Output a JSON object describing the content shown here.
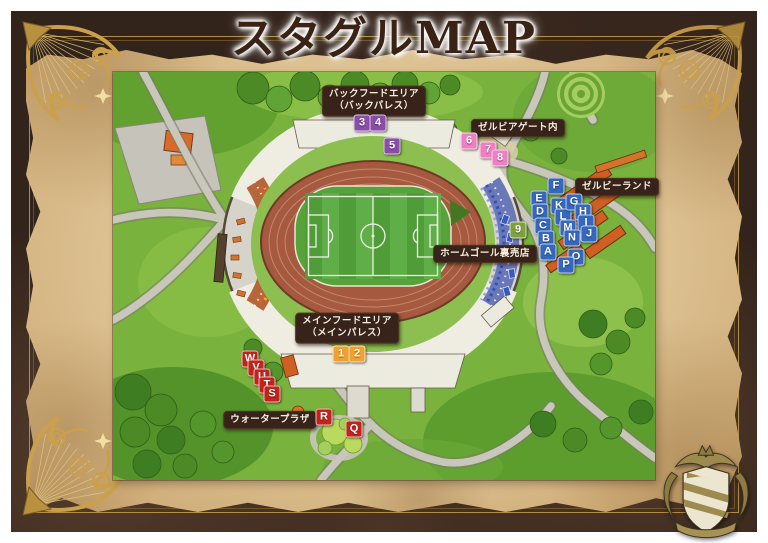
{
  "title": "スタグルMAP",
  "area_labels": [
    {
      "id": "back-food-area",
      "lines": [
        "バックフードエリア",
        "（バックパレス）"
      ],
      "cx": 374,
      "cy": 101
    },
    {
      "id": "zelvia-gate",
      "lines": [
        "ゼルビアゲート内"
      ],
      "cx": 518,
      "cy": 128
    },
    {
      "id": "zelvie-land",
      "lines": [
        "ゼルビーランド"
      ],
      "cx": 617,
      "cy": 187
    },
    {
      "id": "home-goal-shops",
      "lines": [
        "ホームゴール裏売店"
      ],
      "cx": 485,
      "cy": 254
    },
    {
      "id": "main-food-area",
      "lines": [
        "メインフードエリア",
        "（メインパレス）"
      ],
      "cx": 347,
      "cy": 328
    },
    {
      "id": "water-plaza",
      "lines": [
        "ウォータープラザ"
      ],
      "cx": 270,
      "cy": 420
    }
  ],
  "marker_colors": {
    "purple": "#8b4da8",
    "pink": "#f07ec2",
    "orange": "#f2a12c",
    "green": "#7da23d",
    "blue": "#3467bd",
    "red": "#c3231b"
  },
  "markers": [
    {
      "label": "3",
      "color": "purple",
      "cx": 362,
      "cy": 123
    },
    {
      "label": "4",
      "color": "purple",
      "cx": 378,
      "cy": 123
    },
    {
      "label": "5",
      "color": "purple",
      "cx": 392,
      "cy": 146
    },
    {
      "label": "6",
      "color": "pink",
      "cx": 469,
      "cy": 141
    },
    {
      "label": "7",
      "color": "pink",
      "cx": 488,
      "cy": 150
    },
    {
      "label": "8",
      "color": "pink",
      "cx": 500,
      "cy": 158
    },
    {
      "label": "9",
      "color": "green",
      "cx": 518,
      "cy": 230
    },
    {
      "label": "1",
      "color": "orange",
      "cx": 341,
      "cy": 354
    },
    {
      "label": "2",
      "color": "orange",
      "cx": 357,
      "cy": 354
    },
    {
      "label": "F",
      "color": "blue",
      "cx": 556,
      "cy": 186
    },
    {
      "label": "E",
      "color": "blue",
      "cx": 539,
      "cy": 199
    },
    {
      "label": "D",
      "color": "blue",
      "cx": 540,
      "cy": 212
    },
    {
      "label": "C",
      "color": "blue",
      "cx": 543,
      "cy": 226
    },
    {
      "label": "B",
      "color": "blue",
      "cx": 546,
      "cy": 239
    },
    {
      "label": "A",
      "color": "blue",
      "cx": 548,
      "cy": 252
    },
    {
      "label": "K",
      "color": "blue",
      "cx": 559,
      "cy": 206
    },
    {
      "label": "L",
      "color": "blue",
      "cx": 563,
      "cy": 217
    },
    {
      "label": "M",
      "color": "blue",
      "cx": 568,
      "cy": 228
    },
    {
      "label": "N",
      "color": "blue",
      "cx": 572,
      "cy": 238
    },
    {
      "label": "O",
      "color": "blue",
      "cx": 576,
      "cy": 257
    },
    {
      "label": "P",
      "color": "blue",
      "cx": 566,
      "cy": 265
    },
    {
      "label": "G",
      "color": "blue",
      "cx": 574,
      "cy": 202
    },
    {
      "label": "H",
      "color": "blue",
      "cx": 583,
      "cy": 212
    },
    {
      "label": "I",
      "color": "blue",
      "cx": 586,
      "cy": 223
    },
    {
      "label": "J",
      "color": "blue",
      "cx": 589,
      "cy": 234
    },
    {
      "label": "W",
      "color": "red",
      "cx": 250,
      "cy": 359
    },
    {
      "label": "V",
      "color": "red",
      "cx": 256,
      "cy": 368
    },
    {
      "label": "U",
      "color": "red",
      "cx": 262,
      "cy": 377
    },
    {
      "label": "T",
      "color": "red",
      "cx": 267,
      "cy": 385
    },
    {
      "label": "S",
      "color": "red",
      "cx": 272,
      "cy": 394
    },
    {
      "label": "R",
      "color": "red",
      "cx": 324,
      "cy": 417
    },
    {
      "label": "Q",
      "color": "red",
      "cx": 354,
      "cy": 429
    }
  ]
}
